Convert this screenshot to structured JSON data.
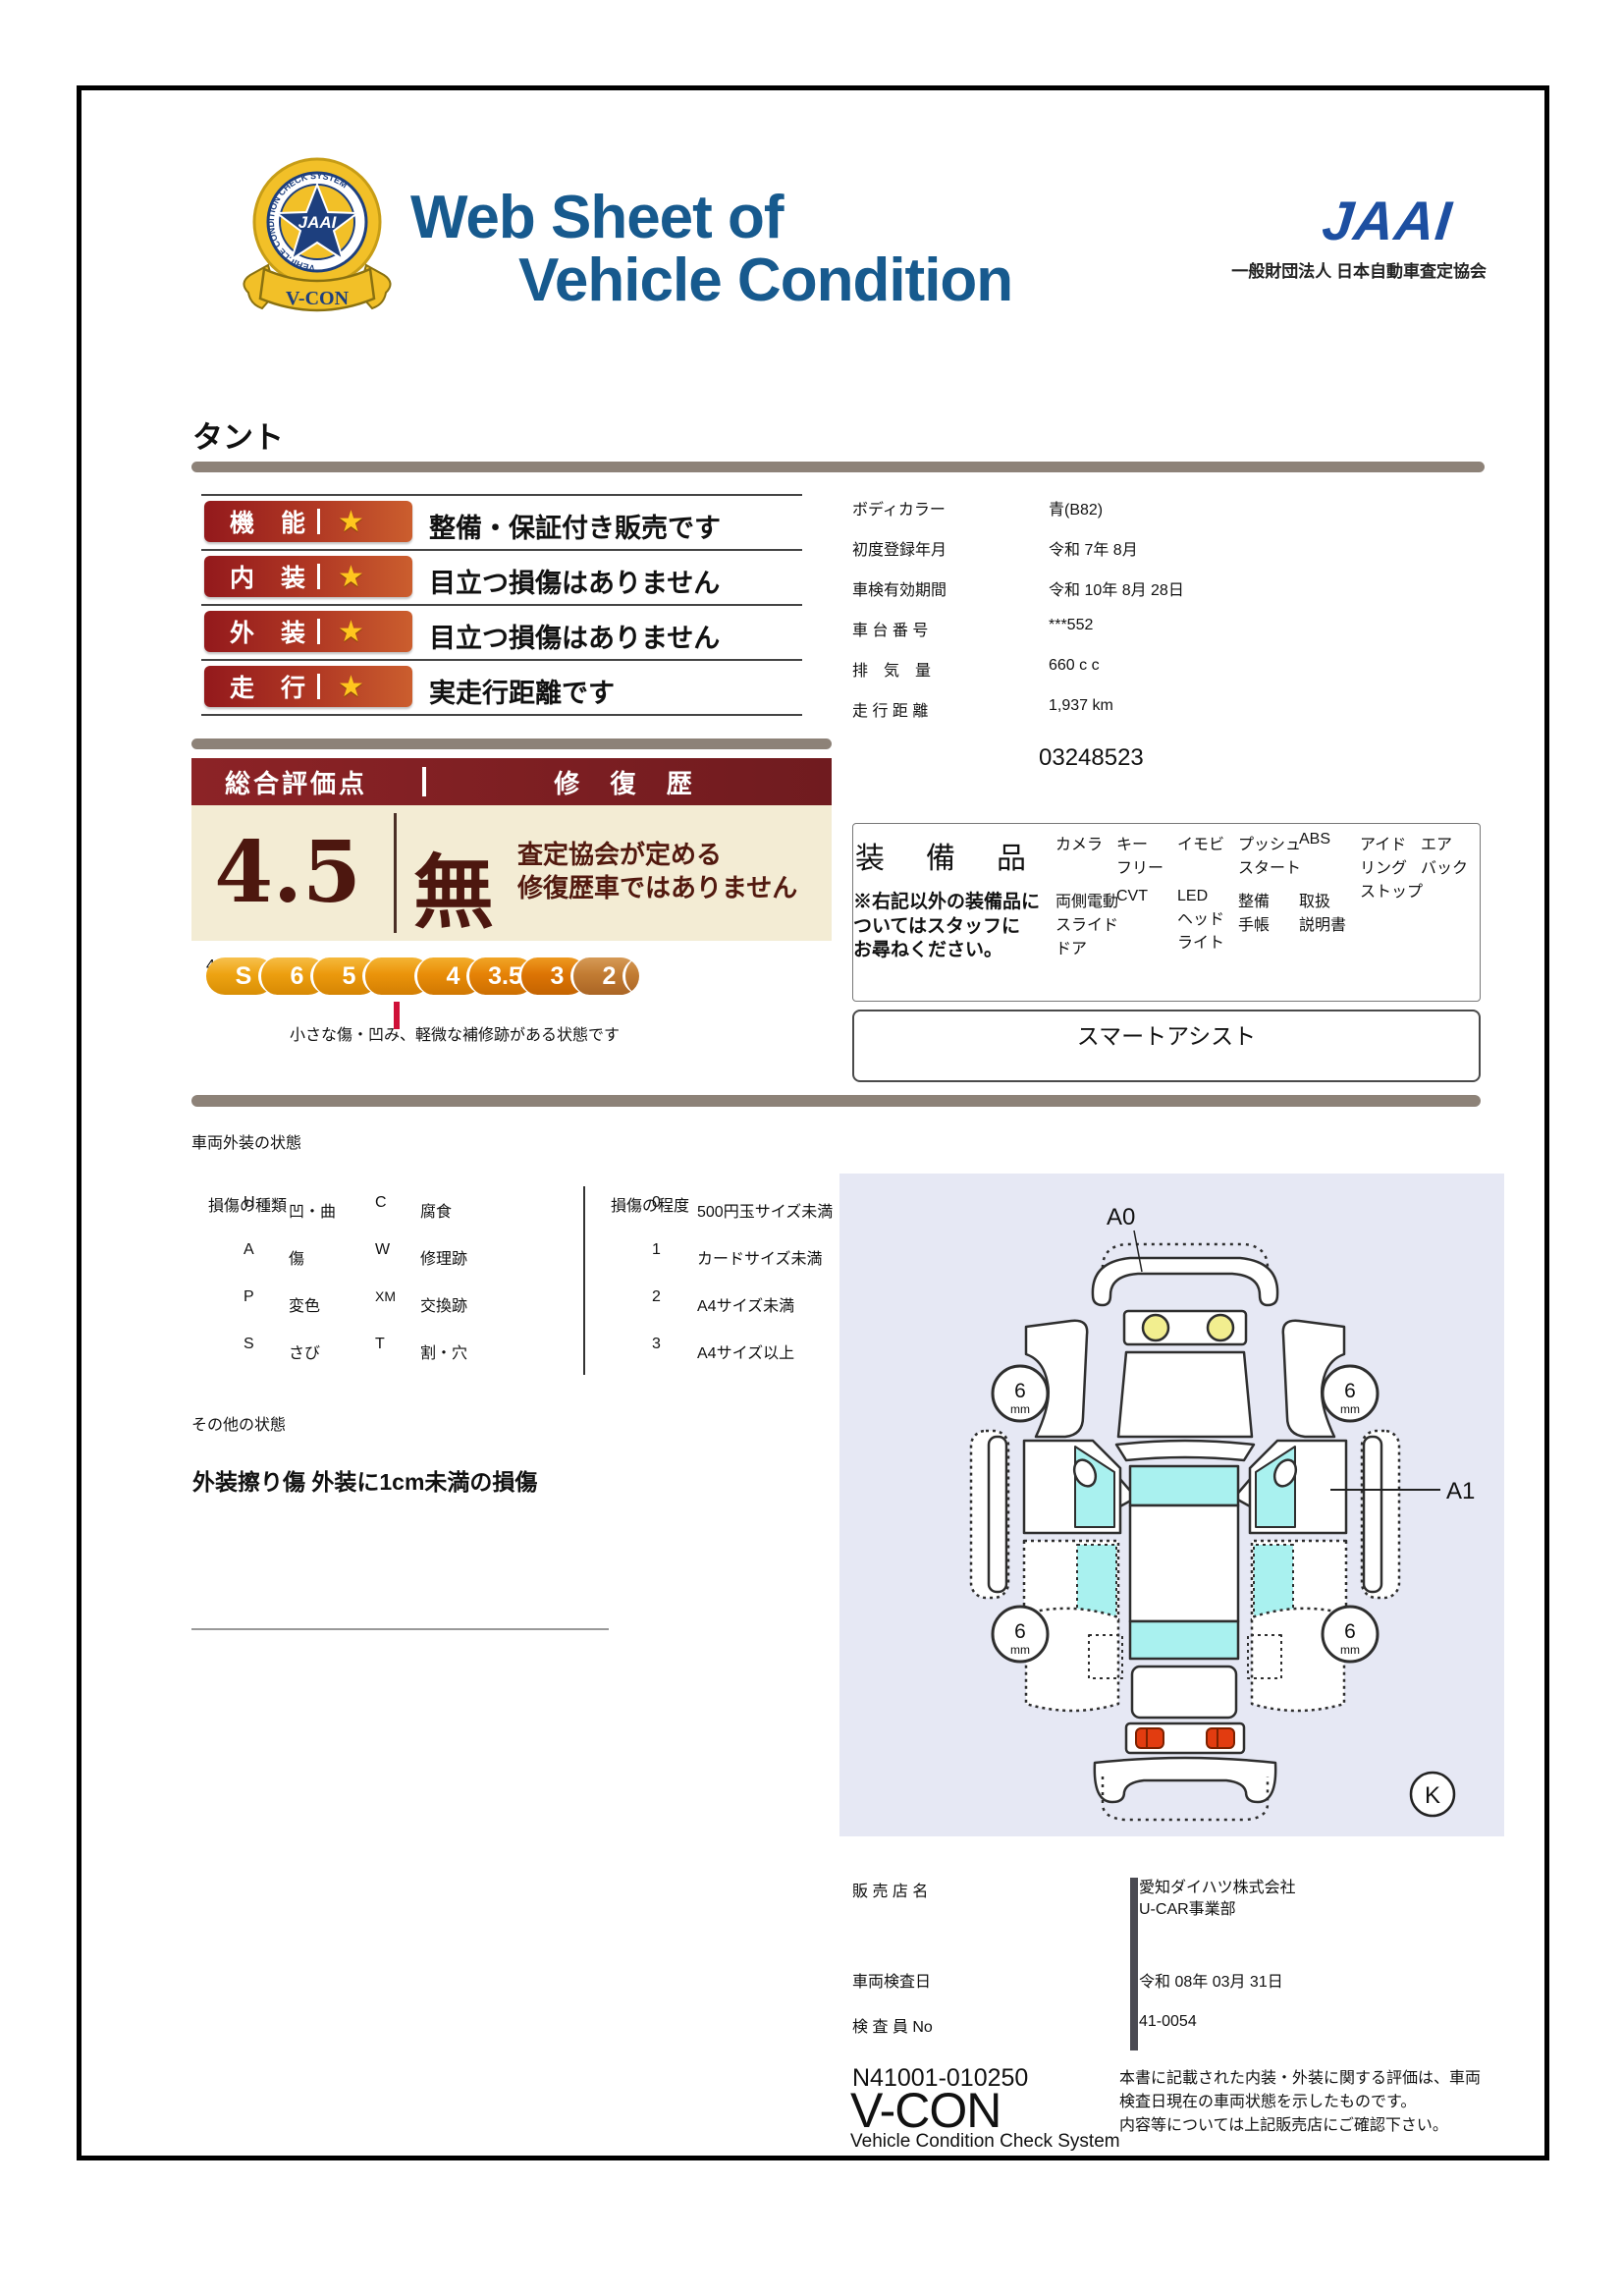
{
  "header": {
    "title_line1": "Web Sheet of",
    "title_line2": "Vehicle Condition",
    "jaai_logo": "JAAI",
    "jaai_subtitle": "一般財団法人 日本自動車査定協会",
    "emblem": {
      "ring_text": "VEHICLE CONDITION CHECK SYSTEM",
      "star_text": "JAAI",
      "ribbon_text": "V-CON"
    }
  },
  "vehicle_name": "タント",
  "ratings": [
    {
      "category": "機 能",
      "star": "★",
      "comment": "整備・保証付き販売です"
    },
    {
      "category": "内 装",
      "star": "★",
      "comment": "目立つ損傷はありません"
    },
    {
      "category": "外 装",
      "star": "★",
      "comment": "目立つ損傷はありません"
    },
    {
      "category": "走 行",
      "star": "★",
      "comment": "実走行距離です"
    }
  ],
  "overall": {
    "score_label": "総合評価点",
    "score": "4.5",
    "repair_label": "修 復 歴",
    "repair_value": "無",
    "repair_note": "査定協会が定める\n修復歴車ではありません",
    "scale": [
      "S",
      "6",
      "5",
      "4.5",
      "4",
      "3.5",
      "3",
      "2",
      "1",
      "R"
    ],
    "selected": "4.5",
    "scale_note": "小さな傷・凹み、軽微な補修跡がある状態です"
  },
  "details": {
    "rows": [
      {
        "label": "ボディカラー",
        "value": "青(B82)"
      },
      {
        "label": "初度登録年月",
        "value": "令和 7年 8月"
      },
      {
        "label": "車検有効期間",
        "value": "令和 10年 8月 28日"
      },
      {
        "label": "車 台 番 号",
        "value": "***552"
      },
      {
        "label": "排　気　量",
        "value": "660 c c"
      },
      {
        "label": "走 行 距 離",
        "value": "1,937 km"
      }
    ],
    "ref_number": "03248523"
  },
  "equipment": {
    "title": "装　備　品",
    "note": "※右記以外の装備品に\nついてはスタッフに\nお尋ねください。",
    "items": [
      "カメラ",
      "キー\nフリー",
      "イモビ",
      "プッシュ\nスタート",
      "ABS",
      "アイド\nリング\nストップ",
      "エア\nバック",
      "両側電動\nスライド\nドア",
      "CVT",
      "LED\nヘッド\nライト",
      "整備\n手帳",
      "取扱\n説明書"
    ],
    "extra": "スマートアシスト"
  },
  "exterior_legend": {
    "section_title": "車両外装の状態",
    "type_label": "損傷の種類",
    "types": [
      {
        "code": "U",
        "label": "凹・曲"
      },
      {
        "code": "C",
        "label": "腐食"
      },
      {
        "code": "A",
        "label": "傷"
      },
      {
        "code": "W",
        "label": "修理跡"
      },
      {
        "code": "P",
        "label": "変色"
      },
      {
        "code": "XM",
        "label": "交換跡"
      },
      {
        "code": "S",
        "label": "さび"
      },
      {
        "code": "T",
        "label": "割・穴"
      }
    ],
    "degree_label": "損傷の程度",
    "degrees": [
      {
        "code": "0",
        "label": "500円玉サイズ未満"
      },
      {
        "code": "1",
        "label": "カードサイズ未満"
      },
      {
        "code": "2",
        "label": "A4サイズ未満"
      },
      {
        "code": "3",
        "label": "A4サイズ以上"
      }
    ]
  },
  "other_state": {
    "section_title": "その他の状態",
    "note": "外装擦り傷 外装に1cm未満の損傷"
  },
  "diagram": {
    "front_label": "A0",
    "side_label": "A1",
    "tread_value": "6",
    "tread_unit": "mm",
    "key_letter": "K"
  },
  "dealer": {
    "rows": [
      {
        "label": "販 売 店 名",
        "value": "愛知ダイハツ株式会社\nU-CAR事業部"
      },
      {
        "label": "車両検査日",
        "value": "令和 08年 03月 31日"
      },
      {
        "label": "検 査 員 No",
        "value": "41-0054"
      }
    ]
  },
  "footer": {
    "doc_number": "N41001-010250",
    "vcon_logo": "V-CON",
    "vcon_sub": "Vehicle Condition Check System",
    "disclaimer": "本書に記載された内装・外装に関する評価は、車両検査日現在の車両状態を示したものです。\n内容等については上記販売店にご確認下さい。"
  },
  "colors": {
    "title_navy": "#175a8e",
    "jaai_blue": "#1d4fa1",
    "badge_red_gradient": [
      "#93191c",
      "#cb5e2e"
    ],
    "star_gold": "#ffc61e",
    "gold_gradient": [
      "#6b5310",
      "#c6a245"
    ],
    "cream": "#f3ecd4",
    "maroon": "#4d170f",
    "crimson": "#cf1038",
    "tab_gray": "#7b7168",
    "bar_gray": "#8d8278",
    "blue_badge": "#1e6f9e",
    "green_badge": "#6ca334",
    "equip_badge": "#877d6f",
    "diagram_bg": "#e6e8f4",
    "glass_cyan": "#a9f1ef",
    "taillight_red": "#e23c10",
    "dealer_pink": "#e7dada",
    "vcon_navy": "#232e7c"
  }
}
